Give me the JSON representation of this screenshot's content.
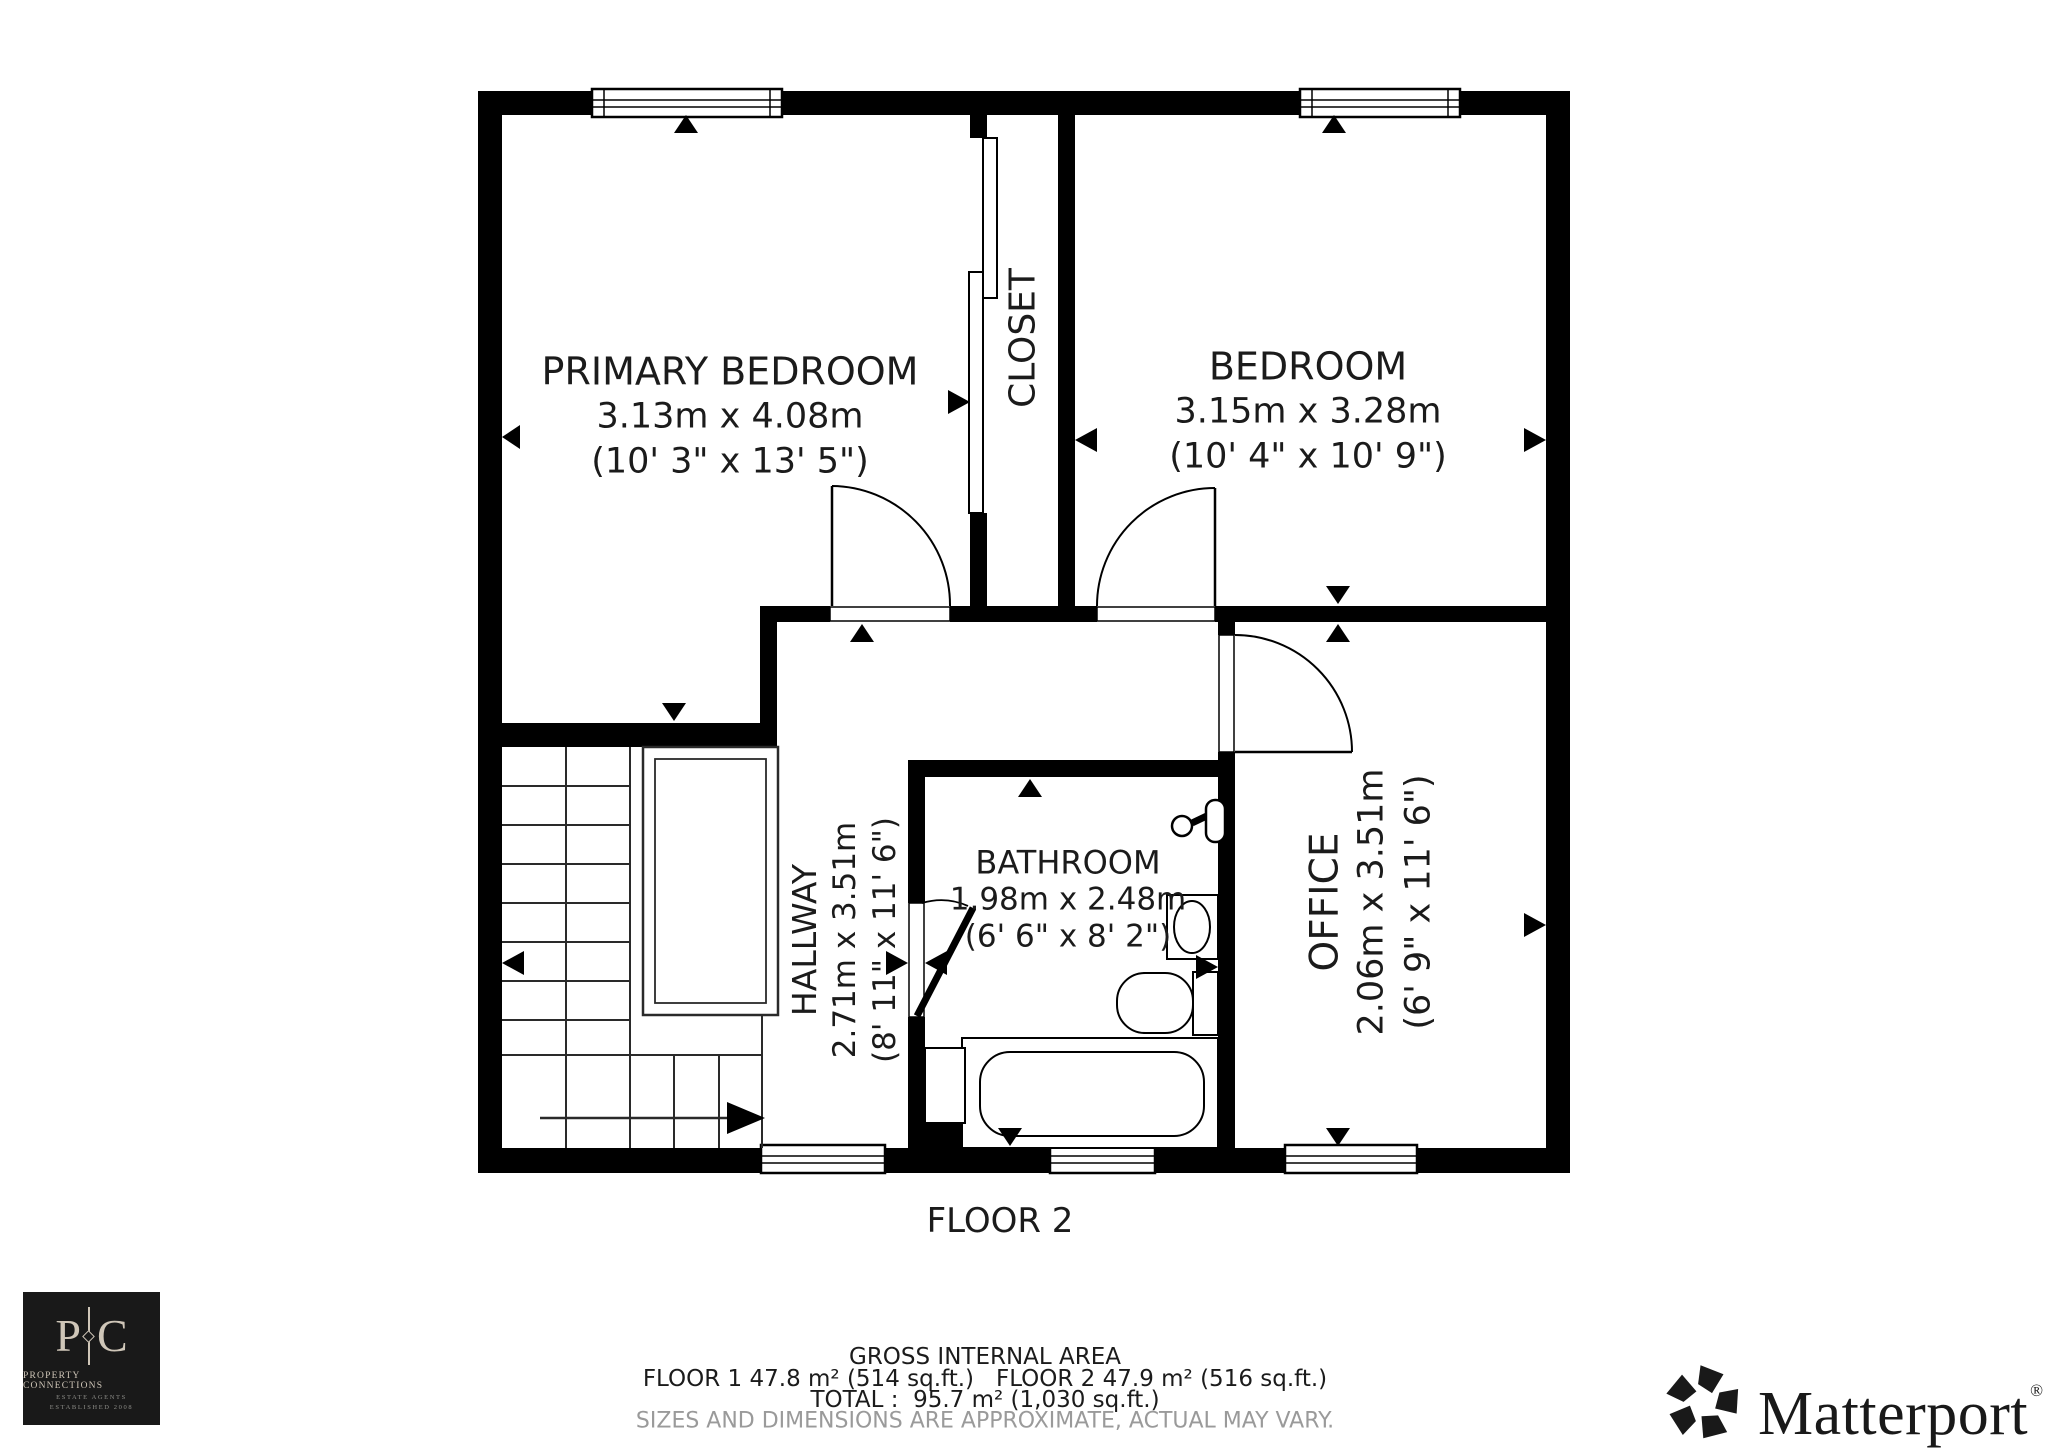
{
  "rooms": {
    "primary_bedroom": {
      "name": "PRIMARY BEDROOM",
      "dims_metric": "3.13m x 4.08m",
      "dims_imperial": "(10' 3\" x 13' 5\")"
    },
    "closet": {
      "name": "CLOSET"
    },
    "bedroom": {
      "name": "BEDROOM",
      "dims_metric": "3.15m x 3.28m",
      "dims_imperial": "(10' 4\" x 10' 9\")"
    },
    "hallway": {
      "name": "HALLWAY",
      "dims_metric": "2.71m x 3.51m",
      "dims_imperial": "(8' 11\" x 11' 6\")"
    },
    "bathroom": {
      "name": "BATHROOM",
      "dims_metric": "1.98m x 2.48m",
      "dims_imperial": "(6' 6\" x 8' 2\")"
    },
    "office": {
      "name": "OFFICE",
      "dims_metric": "2.06m x 3.51m",
      "dims_imperial": "(6' 9\" x 11' 6\")"
    }
  },
  "floor_label": "FLOOR 2",
  "footer": {
    "title": "GROSS INTERNAL AREA",
    "floors": "FLOOR 1 47.8 m² (514 sq.ft.)   FLOOR 2 47.9 m² (516 sq.ft.)",
    "total": "TOTAL :  95.7 m² (1,030 sq.ft.)",
    "disclaimer": "SIZES AND DIMENSIONS ARE APPROXIMATE, ACTUAL MAY VARY."
  },
  "branding": {
    "agency": {
      "initial_left": "P",
      "initial_right": "C",
      "name": "PROPERTY CONNECTIONS",
      "sub1": "ESTATE AGENTS",
      "sub2": "ESTABLISHED 2008"
    },
    "matterport": {
      "name": "Matterport",
      "registered": "®"
    }
  },
  "colors": {
    "wall": "#000000",
    "text": "#1b1b1b",
    "disclaimer_gray": "#9a9a9a",
    "agency_bg": "#191919",
    "agency_text": "#cfc6b8"
  }
}
